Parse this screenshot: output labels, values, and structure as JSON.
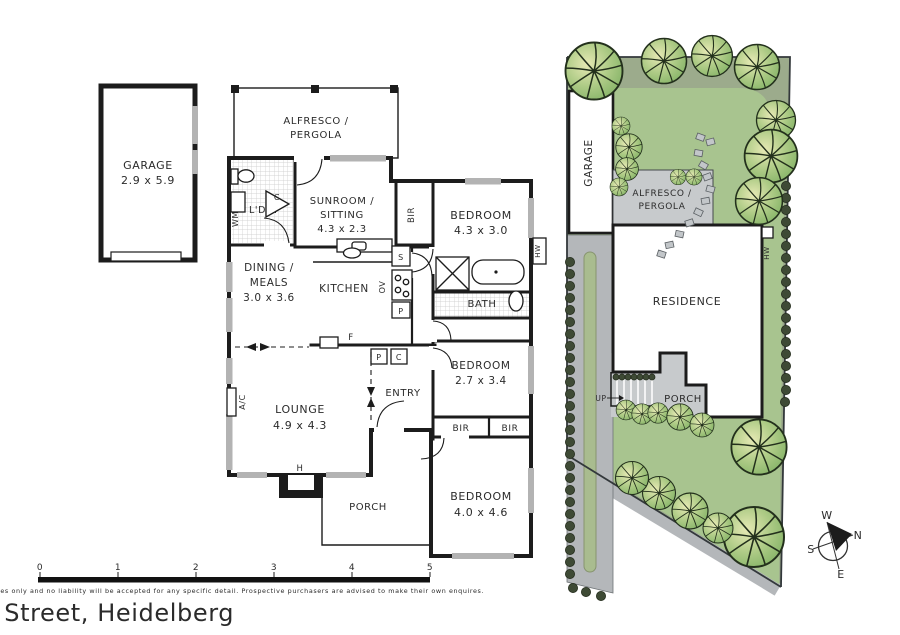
{
  "footer": {
    "address": "51 Mortimer Street, Heidelberg",
    "disclaimer": "Scale bar in metres. Dimentions shown are approximate. Please note that this plan is for illustrative purposes only and no liability will be accepted for any specific detail. Prospective purchasers are advised to make their own enquires.",
    "ticks": [
      "0",
      "1",
      "2",
      "3",
      "4",
      "5"
    ]
  },
  "compass": {
    "n": "N",
    "s": "S",
    "e": "E",
    "w": "W"
  },
  "floor_plan": {
    "garage": {
      "name": "GARAGE",
      "dims": "2.9 x 5.9"
    },
    "alfresco": {
      "l1": "ALFRESCO /",
      "l2": "PERGOLA"
    },
    "sunroom": {
      "l1": "SUNROOM /",
      "l2": "SITTING",
      "dims": "4.3 x 2.3"
    },
    "bedroom1": {
      "name": "BEDROOM",
      "dims": "4.3 x 3.0"
    },
    "dining": {
      "l1": "DINING /",
      "l2": "MEALS",
      "dims": "3.0 x 3.6"
    },
    "kitchen": {
      "name": "KITCHEN"
    },
    "bath": {
      "name": "BATH"
    },
    "bedroom2": {
      "name": "BEDROOM",
      "dims": "2.7 x 3.4"
    },
    "lounge": {
      "name": "LOUNGE",
      "dims": "4.9 x 4.3"
    },
    "entry": {
      "name": "ENTRY"
    },
    "porch": {
      "name": "PORCH"
    },
    "bedroom3": {
      "name": "BEDROOM",
      "dims": "4.0 x 4.6"
    },
    "tags": {
      "ldry": "L'DRY",
      "wm": "WM",
      "c": "C",
      "s": "S",
      "ov": "OV",
      "p": "P",
      "f": "F",
      "bir": "BIR",
      "hw": "HW",
      "ac": "A/C",
      "h": "H"
    }
  },
  "site_plan": {
    "garage": "GARAGE",
    "alfresco_l1": "ALFRESCO /",
    "alfresco_l2": "PERGOLA",
    "residence": "RESIDENCE",
    "porch": "PORCH",
    "up": "UP",
    "hw": "HW"
  },
  "colors": {
    "lawn": "#a8c48f",
    "verge": "#9cab8c",
    "driveway": "#b4b7ba",
    "paving": "#c7cacc",
    "garden_strip": "#a9bc8f",
    "wall": "#1c1c1c"
  }
}
